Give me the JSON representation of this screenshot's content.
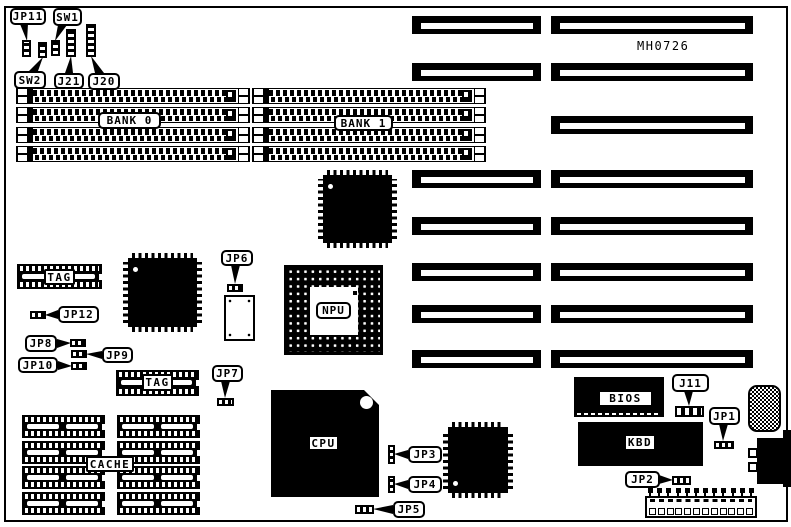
{
  "part_number": "MH0726",
  "memory": {
    "bank0_label": "BANK 0",
    "bank1_label": "BANK 1"
  },
  "cache": {
    "label": "CACHE",
    "tag_upper_label": "TAG",
    "tag_lower_label": "TAG"
  },
  "chips": {
    "npu_label": "NPU",
    "cpu_label": "CPU",
    "bios_label": "BIOS",
    "kbd_label": "KBD"
  },
  "jumpers": {
    "jp11": "JP11",
    "sw1": "SW1",
    "sw2": "SW2",
    "j21": "J21",
    "j20": "J20",
    "jp6": "JP6",
    "jp12": "JP12",
    "jp8": "JP8",
    "jp9": "JP9",
    "jp10": "JP10",
    "jp7": "JP7",
    "jp3": "JP3",
    "jp4": "JP4",
    "jp5": "JP5",
    "j11": "J11",
    "jp1": "JP1",
    "jp2": "JP2"
  }
}
